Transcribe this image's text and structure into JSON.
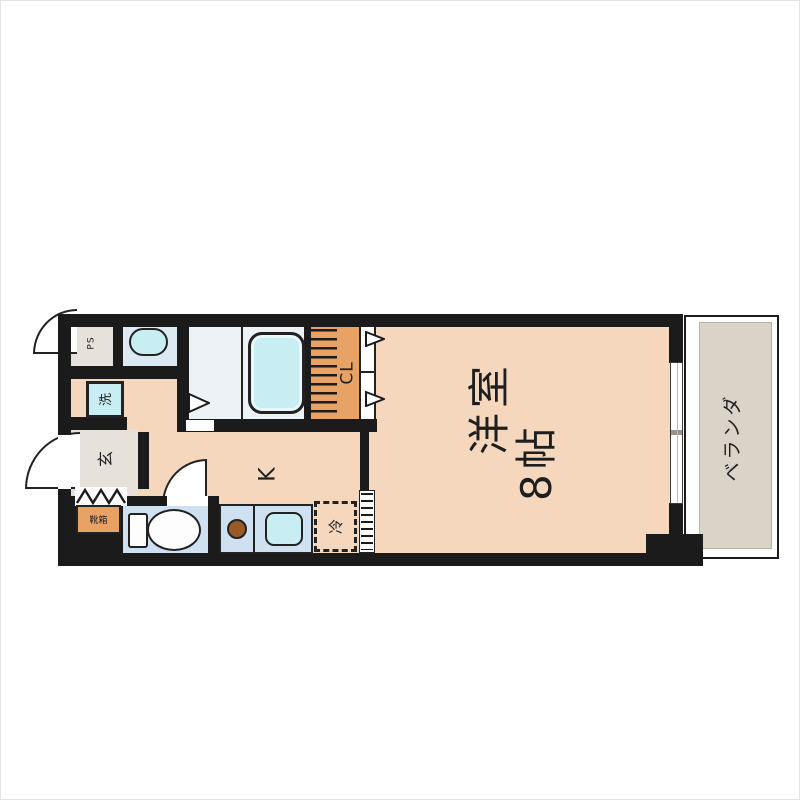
{
  "floorplan": {
    "type": "apartment-floorplan-1K",
    "labels": {
      "main_room_line1": "洋室",
      "main_room_line2": "8帖",
      "kitchen": "K",
      "closet": "CL",
      "veranda": "ベランダ",
      "entrance": "玄",
      "pipe_space": "PS",
      "washer": "洗",
      "fridge": "冷",
      "shoe_box": "靴箱"
    },
    "colors": {
      "floor_tan": "#f5d7bd",
      "wall_black": "#1b1b1b",
      "bath_floor": "#edf2f7",
      "fixture_panel_blue": "#cfe1f1",
      "fixture_cyan": "#c8edf2",
      "closet_orange": "#e8a263",
      "veranda_gray": "#dad3c8",
      "service_gray": "#e6e1da",
      "burner_brown": "#9a5a28",
      "background": "#ffffff"
    }
  }
}
